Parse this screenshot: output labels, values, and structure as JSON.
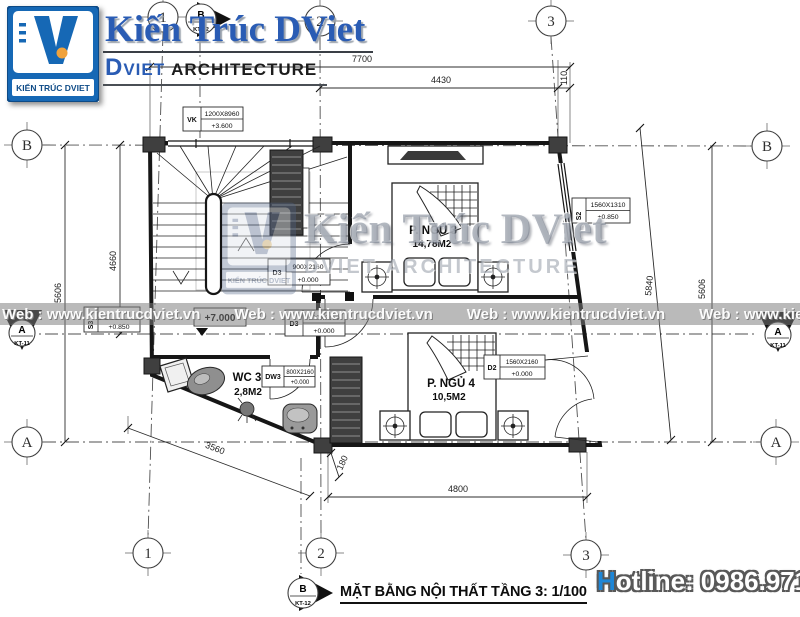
{
  "header": {
    "logo_caption": "KIẾN TRÚC DVIET",
    "brand_title": "Kiến Trúc DViet",
    "subtitle_d": "D",
    "subtitle_viet": "VIET",
    "subtitle_rest": "ARCHITECTURE"
  },
  "watermark": {
    "web": "Web : www.kientrucdviet.vn",
    "brand_large": "Kiến Trúc DViet",
    "brand_sub": "DVIET ARCHITECTURE",
    "logo_caption": "KIẾN TRÚC DVIET"
  },
  "footer": {
    "drawing_title": "MẶT BẰNG NỘI THẤT TẦNG 3: 1/100",
    "hotline_h": "H",
    "hotline_rest": "otline:",
    "hotline_number": "0986.971.699"
  },
  "grid": {
    "c1": "1",
    "c2": "2",
    "c3": "3",
    "rA": "A",
    "rB": "B"
  },
  "markers": {
    "kt11_letter": "A",
    "kt11_sheet": "KT-11",
    "kt12_letter": "B",
    "kt12_sheet": "KT-12"
  },
  "dims": {
    "top_total": "7700",
    "top_span": "4430",
    "top_off": "110",
    "left_outer": "5606",
    "left_inner": "4660",
    "right_outer": "5606",
    "right_slant": "5840",
    "bottom_span": "4800",
    "bottom_small": "180",
    "diag": "3560"
  },
  "rooms": {
    "ngu3": {
      "name": "P. NGỦ 3",
      "area": "14,78M2"
    },
    "ngu4": {
      "name": "P. NGỦ 4",
      "area": "10,5M2"
    },
    "wc3": {
      "name": "WC 3",
      "area": "2,8M2"
    }
  },
  "tags": {
    "vk": {
      "code": "VK",
      "size": "1200X8960",
      "level": "+3.600"
    },
    "d3a": {
      "code": "D3",
      "size": "900X2160",
      "level": "+0.000"
    },
    "d3b": {
      "code": "D3",
      "size": "900X2160",
      "level": "+0.000"
    },
    "dw3": {
      "code": "DW3",
      "size": "800X2160",
      "level": "+0.000"
    },
    "d2": {
      "code": "D2",
      "size": "1560X2160",
      "level": "+0.000"
    },
    "s2": {
      "code": "S2",
      "size": "1560X1310",
      "level": "+0.850"
    },
    "s3": {
      "code": "S3",
      "level": "+0.850"
    },
    "landing_level": "+7.000"
  }
}
